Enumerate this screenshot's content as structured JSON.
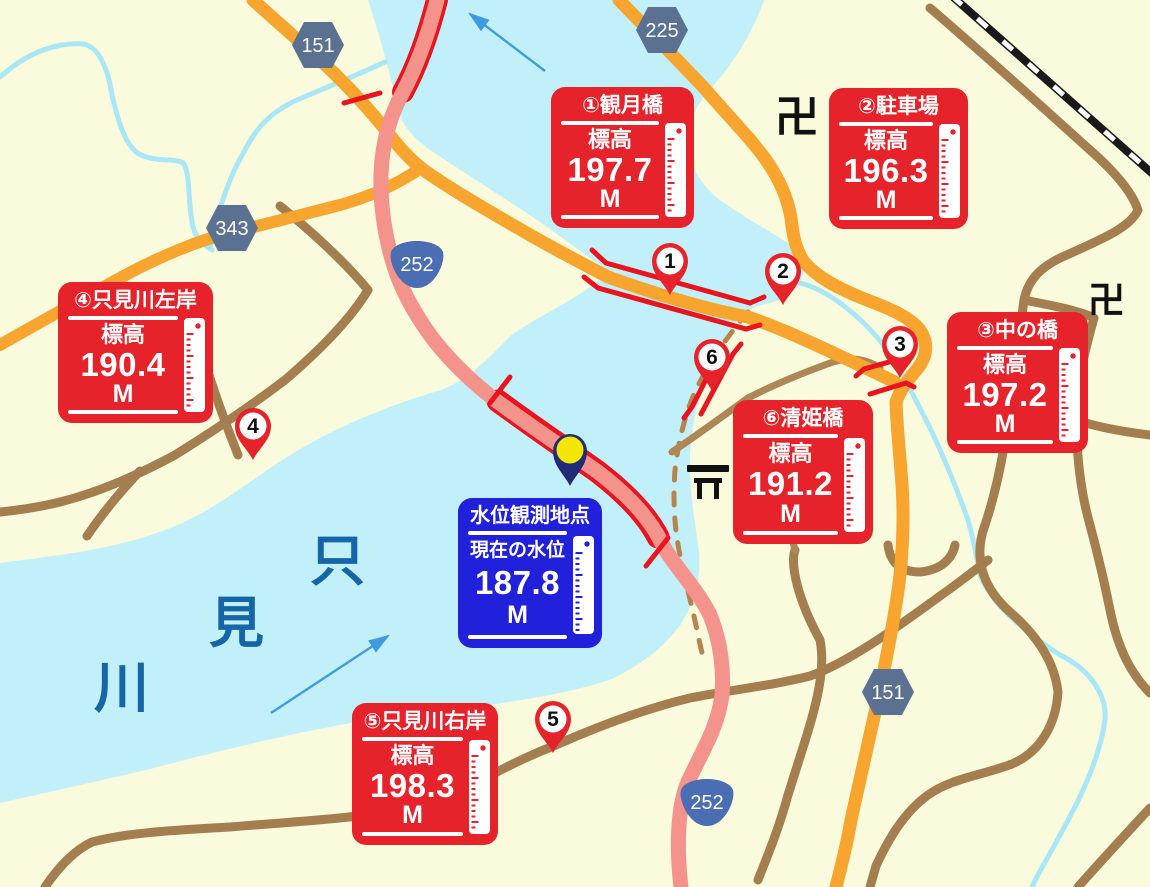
{
  "cards": [
    {
      "title": "①観月橋",
      "label": "標高",
      "value": "197.7",
      "unit": "M"
    },
    {
      "title": "②駐車場",
      "label": "標高",
      "value": "196.3",
      "unit": "M"
    },
    {
      "title": "③中の橋",
      "label": "標高",
      "value": "197.2",
      "unit": "M"
    },
    {
      "title": "④只見川左岸",
      "label": "標高",
      "value": "190.4",
      "unit": "M"
    },
    {
      "title": "⑤只見川右岸",
      "label": "標高",
      "value": "198.3",
      "unit": "M"
    },
    {
      "title": "⑥清姫橋",
      "label": "標高",
      "value": "191.2",
      "unit": "M"
    }
  ],
  "observation": {
    "title": "水位観測地点",
    "label": "現在の水位",
    "value": "187.8",
    "unit": "M"
  },
  "badges": [
    {
      "number": "151"
    },
    {
      "number": "225"
    },
    {
      "number": "343"
    },
    {
      "number": "252"
    },
    {
      "number": "252"
    },
    {
      "number": "151"
    }
  ],
  "pins": [
    {
      "number": "1"
    },
    {
      "number": "2"
    },
    {
      "number": "3"
    },
    {
      "number": "4"
    },
    {
      "number": "5"
    },
    {
      "number": "6"
    }
  ],
  "river_name": {
    "char1": "只",
    "char2": "見",
    "char3": "川"
  },
  "map_symbols": {
    "temple1": "卍",
    "temple2": "卍"
  },
  "colors": {
    "land": "#fafadc",
    "water": "#c2f0fa",
    "stream": "#a9e7f7",
    "road_orange": "#f7a52e",
    "road_brown": "#a57e4f",
    "road_pink": "#f4938c",
    "bridge_red": "#e8141e",
    "card_red": "#e6222b",
    "card_blue": "#2121dc",
    "badge_hex": "#5b7191",
    "badge_national": "#4a6db3",
    "river_text": "#1565a8",
    "arrow": "#3f9ce0",
    "obs_pin_navy": "#202c78",
    "obs_pin_yellow": "#f5e600",
    "rail": "#1a1a1a"
  }
}
